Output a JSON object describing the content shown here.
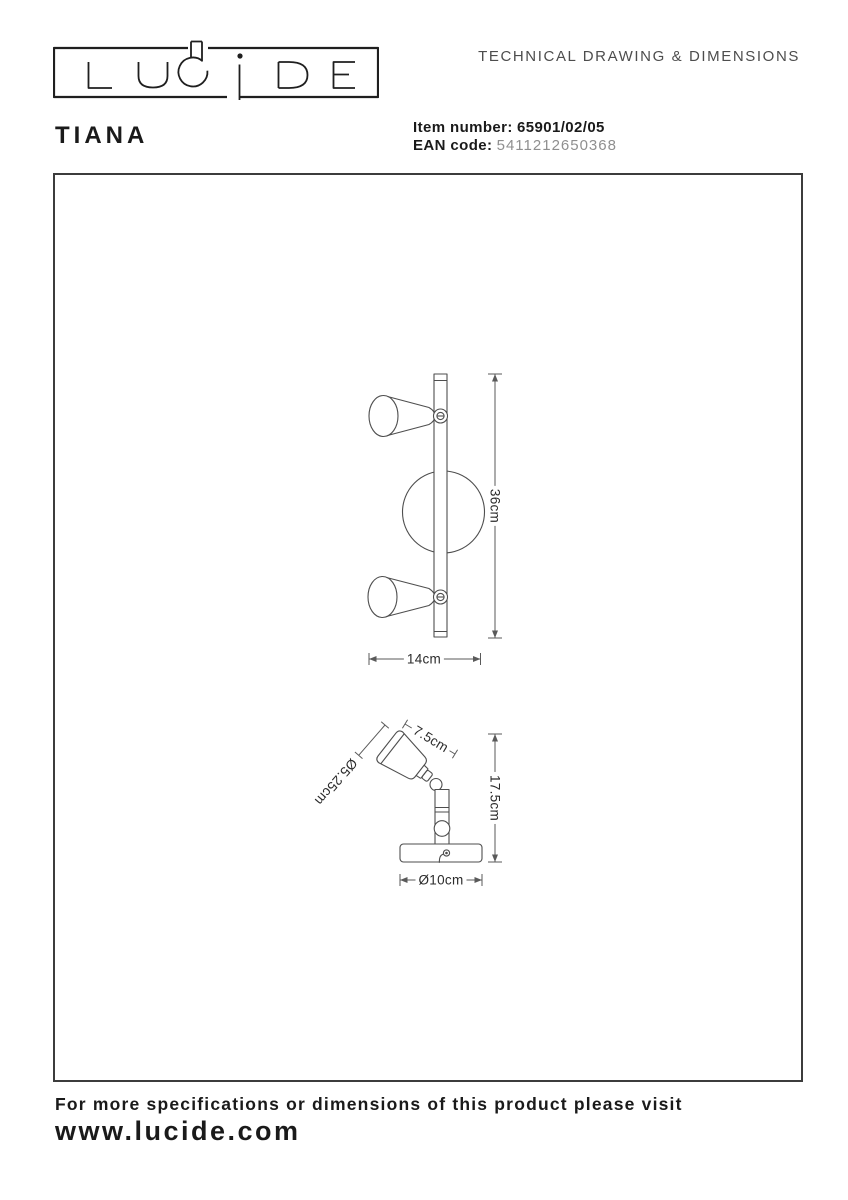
{
  "header": {
    "logo_text": "LUCIDE",
    "doc_title": "TECHNICAL DRAWING & DIMENSIONS"
  },
  "product": {
    "name": "TIANA",
    "item_label": "Item number:",
    "item_value": "65901/02/05",
    "ean_label": "EAN code:",
    "ean_value": "5411212650368"
  },
  "drawing": {
    "front": {
      "height": "36cm",
      "width": "14cm"
    },
    "side": {
      "head_length": "7.5cm",
      "head_diameter": "Ø5.25cm",
      "height": "17.5cm",
      "base_diameter": "Ø10cm"
    }
  },
  "footer": {
    "note": "For more specifications or dimensions of this product please visit",
    "url": "www.lucide.com"
  },
  "colors": {
    "ink": "#1a1a1a",
    "drawing_line": "#4e4e4e",
    "doc_title_gray": "#4d4d4d",
    "ean_gray": "#8f8f8f",
    "background": "#ffffff"
  }
}
